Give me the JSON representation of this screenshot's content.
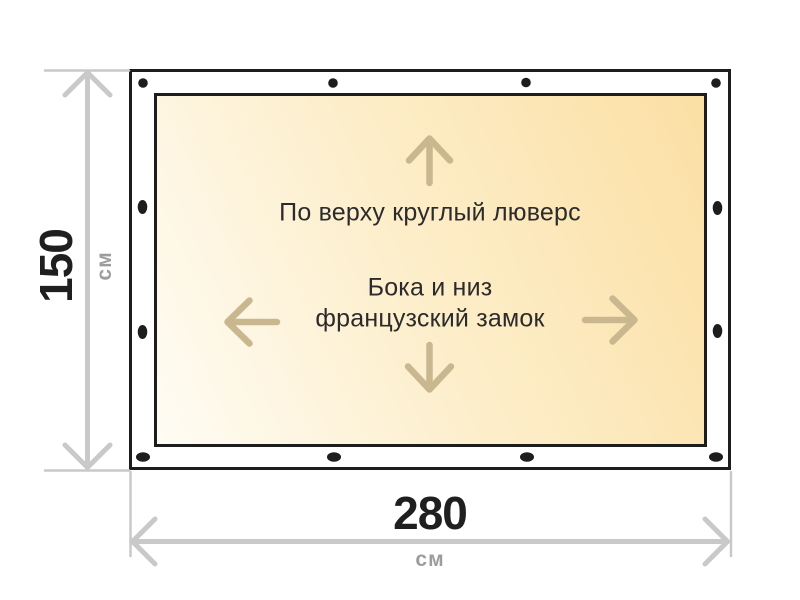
{
  "diagram": {
    "title_implied": "Размеры тента",
    "height_dimension": {
      "value": "150",
      "unit": "см"
    },
    "width_dimension": {
      "value": "280",
      "unit": "см"
    },
    "annotations": {
      "top": "По верху круглый люверс",
      "middle_line1": "Бока и низ",
      "middle_line2": "французский замок"
    },
    "colors": {
      "outline_black": "#1d1d1d",
      "fabric_gradient_start": "#fefcf4",
      "fabric_gradient_end": "#fbdfa4",
      "dimension_line_gray": "#c9c9c9",
      "unit_text_gray": "#9d9d9d",
      "value_text_black": "#1f1f1f",
      "annotation_text": "#2b2b2b",
      "direction_arrow_tan": "#c9b88f"
    },
    "fasteners": {
      "top_edge_grommets_count": 4,
      "bottom_edge_slots_count": 4,
      "left_edge_slots_count": 2,
      "right_edge_slots_count": 2
    }
  }
}
